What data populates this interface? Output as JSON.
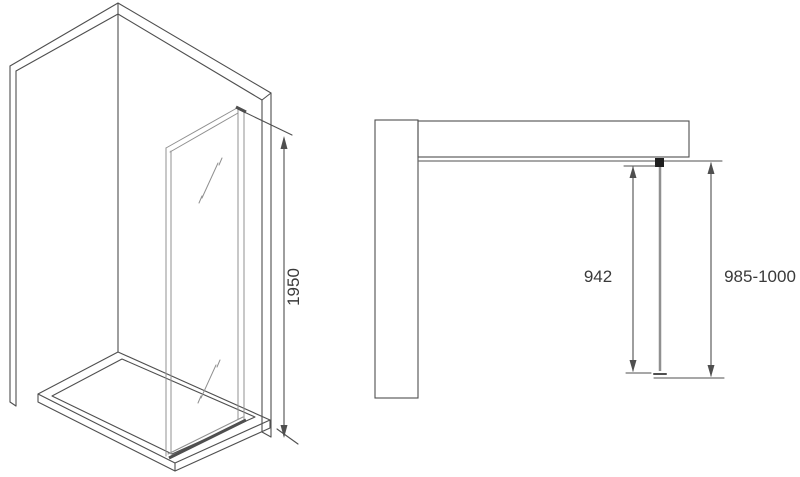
{
  "views": {
    "perspective": {
      "dimension": {
        "label": "1950"
      }
    },
    "plan": {
      "dimensions": [
        {
          "id": "glass-width",
          "label": "942"
        },
        {
          "id": "total-width",
          "label": "985-1000"
        }
      ]
    }
  },
  "colors": {
    "line": "#4f4f4f",
    "glass_line": "#909090",
    "mortar": "#606060",
    "brick": "#ffffff",
    "bracket": "#1e1e1e",
    "text": "#3a3a3a",
    "background": "#ffffff"
  }
}
